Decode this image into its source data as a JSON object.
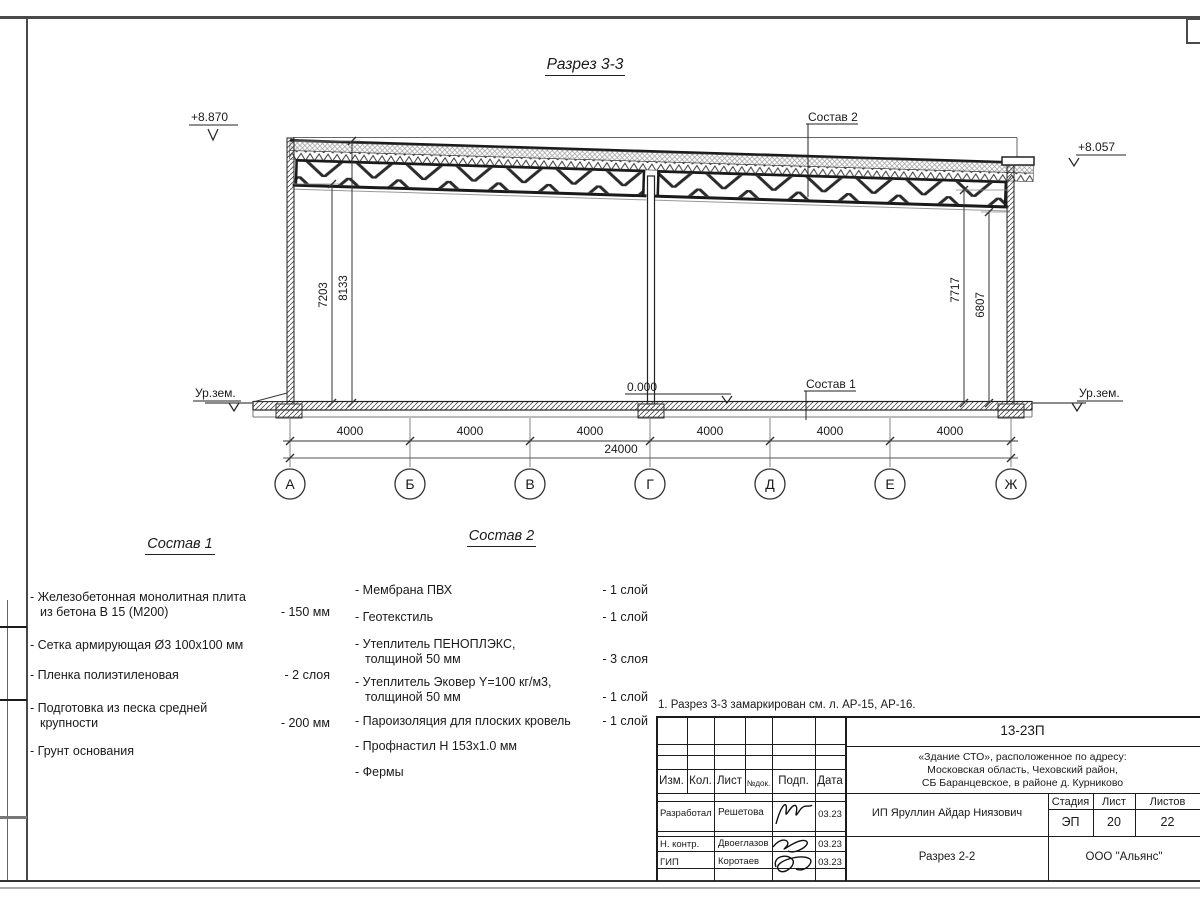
{
  "sheet": {
    "title": "Разрез 3-3",
    "note": "1. Разрез 3-3 замаркирован см. л. АР-15, АР-16."
  },
  "drawing": {
    "elev_left_top": "+8.870",
    "elev_right_top": "+8.057",
    "elev_floor": "0.000",
    "ground_left": "Ур.зем.",
    "ground_right": "Ур.зем.",
    "leader_sostav1": "Состав 1",
    "leader_sostav2": "Состав 2",
    "vdims": [
      "7203",
      "8133",
      "7717",
      "6807"
    ],
    "span_dims": [
      "4000",
      "4000",
      "4000",
      "4000",
      "4000",
      "4000"
    ],
    "total_dim": "24000",
    "axes": [
      "А",
      "Б",
      "В",
      "Г",
      "Д",
      "Е",
      "Ж"
    ]
  },
  "sostav1": {
    "title": "Состав 1",
    "items": [
      {
        "text": "- Железобетонная  монолитная плита из бетона В 15 (М200)",
        "value": "- 150 мм"
      },
      {
        "text": "- Сетка армирующая Ø3 100х100 мм",
        "value": ""
      },
      {
        "text": "- Пленка полиэтиленовая",
        "value": "-  2 слоя"
      },
      {
        "text": "- Подготовка из песка средней крупности",
        "value": "- 200 мм"
      },
      {
        "text": "- Грунт основания",
        "value": ""
      }
    ]
  },
  "sostav2": {
    "title": "Состав 2",
    "items": [
      {
        "text": "- Мембрана ПВХ",
        "value": "- 1 слой"
      },
      {
        "text": "- Геотекстиль",
        "value": "- 1 слой"
      },
      {
        "text": "- Утеплитель ПЕНОПЛЭКС, толщиной 50 мм",
        "value": "- 3 слоя"
      },
      {
        "text": "- Утеплитель Эковер Y=100 кг/м3, толщиной 50 мм",
        "value": "- 1 слой"
      },
      {
        "text": "- Пароизоляция для плоских кровель",
        "value": "- 1 слой"
      },
      {
        "text": "- Профнастил Н 153х1.0 мм",
        "value": ""
      },
      {
        "text": "- Фермы",
        "value": ""
      }
    ]
  },
  "titleblock": {
    "doc_number": "13-23П",
    "project_line1": "«Здание СТО», расположенное по адресу:",
    "project_line2": "Московская область, Чеховский район,",
    "project_line3": "СБ Баранцевское, в районе д. Курниково",
    "col_izm": "Изм.",
    "col_kol": "Кол.",
    "col_list": "Лист",
    "col_ndok": "№док.",
    "col_podp": "Подп.",
    "col_data": "Дата",
    "row1_role": "Разработал",
    "row1_name": "Решетова",
    "row1_date": "03.23",
    "row2_role": "Н. контр.",
    "row2_name": "Двоеглазов",
    "row2_date": "03.23",
    "row3_role": "ГИП",
    "row3_name": "Коротаев",
    "row3_date": "03.23",
    "client": "ИП Яруллин Айдар Ниязович",
    "stage_label": "Стадия",
    "sheet_label": "Лист",
    "sheets_label": "Листов",
    "stage": "ЭП",
    "sheet_no": "20",
    "sheets_total": "22",
    "sheet_name": "Разрез 2-2",
    "company": "ООО \"Альянс\""
  }
}
